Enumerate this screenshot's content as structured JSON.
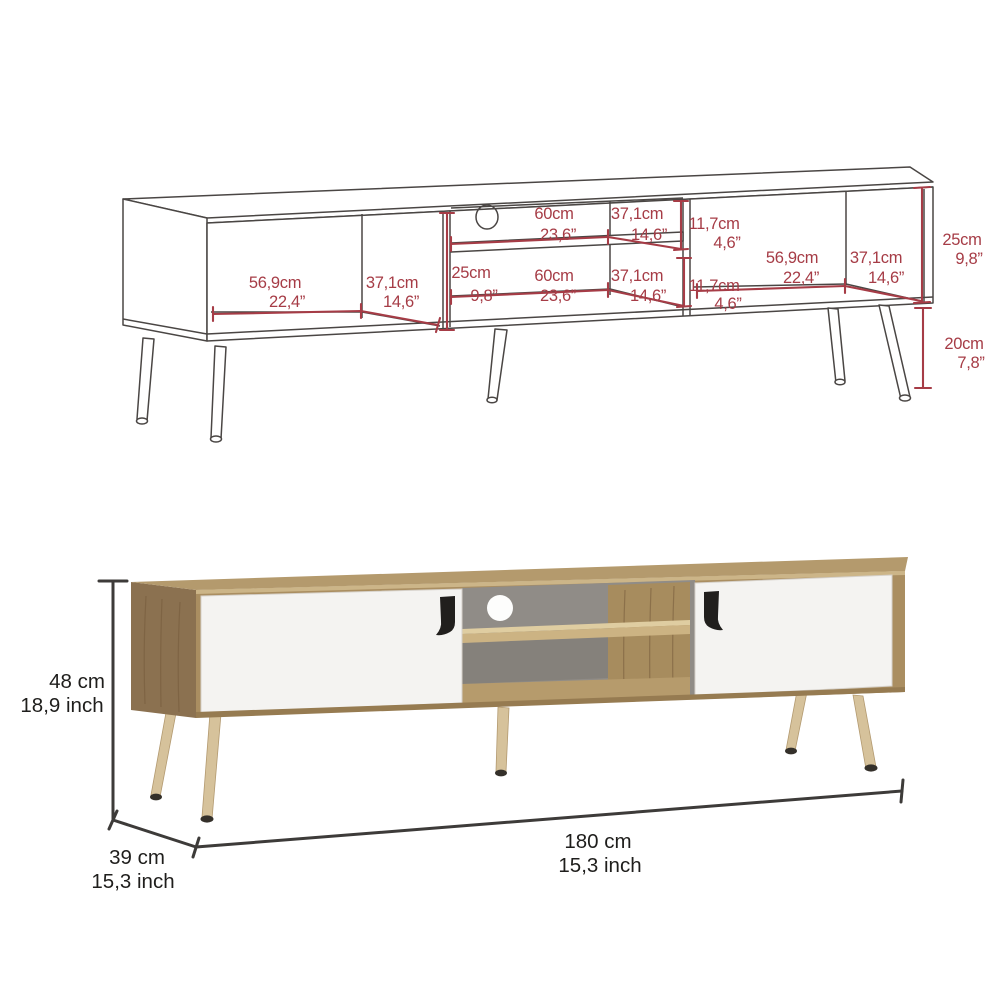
{
  "technical_drawing": {
    "left_compartment": {
      "width_cm": "56,9cm",
      "width_in": "22,4”",
      "depth_cm": "37,1cm",
      "depth_in": "14,6”"
    },
    "middle_upper": {
      "width_cm": "60cm",
      "width_in": "23,6”",
      "depth_cm": "37,1cm",
      "depth_in": "14,6”",
      "height_cm": "11,7cm",
      "height_in": "4,6”"
    },
    "middle_lower": {
      "width_cm": "60cm",
      "width_in": "23,6”",
      "depth_cm": "37,1cm",
      "depth_in": "14,6”",
      "height_cm": "11,7cm",
      "height_in": "4,6”"
    },
    "middle_left_height": {
      "cm": "25cm",
      "in": "9,8”"
    },
    "right_compartment": {
      "width_cm": "56,9cm",
      "width_in": "22,4”",
      "depth_cm": "37,1cm",
      "depth_in": "14,6”"
    },
    "body_height": {
      "cm": "25cm",
      "in": "9,8”"
    },
    "leg_height": {
      "cm": "20cm",
      "in": "7,8”"
    }
  },
  "product_view": {
    "height": {
      "cm": "48 cm",
      "inch": "18,9 inch"
    },
    "depth": {
      "cm": "39 cm",
      "inch": "15,3 inch"
    },
    "width": {
      "cm": "180 cm",
      "inch": "15,3 inch"
    }
  },
  "colors": {
    "dimension_red": "#a63c46",
    "drawing_line": "#4a4644",
    "dimension_black": "#3d3b39",
    "text_black": "#1f1e1c",
    "wood_top": "#b49a6d",
    "wood_top_edge": "#ccb588",
    "wood_side": "#8b7150",
    "wood_grain": "#74593b",
    "wood_frame": "#aa8e61",
    "wood_divider": "#a78c5e",
    "wood_shelf": "#ccb383",
    "wood_shelf_top": "#dfcda1",
    "wood_floor": "#b69b6c",
    "wood_rim": "#967b51",
    "wood_leg": "#d6c29b",
    "wood_leg_edge": "#b39a70",
    "leg_foot": "#34302a",
    "door_white": "#f4f3f1",
    "door_edge": "#d6d1ca",
    "back_panel": "#908c87",
    "back_panel_dark": "#85817b",
    "hole_white": "#fdfdfc",
    "handle_black": "#211f1d"
  }
}
